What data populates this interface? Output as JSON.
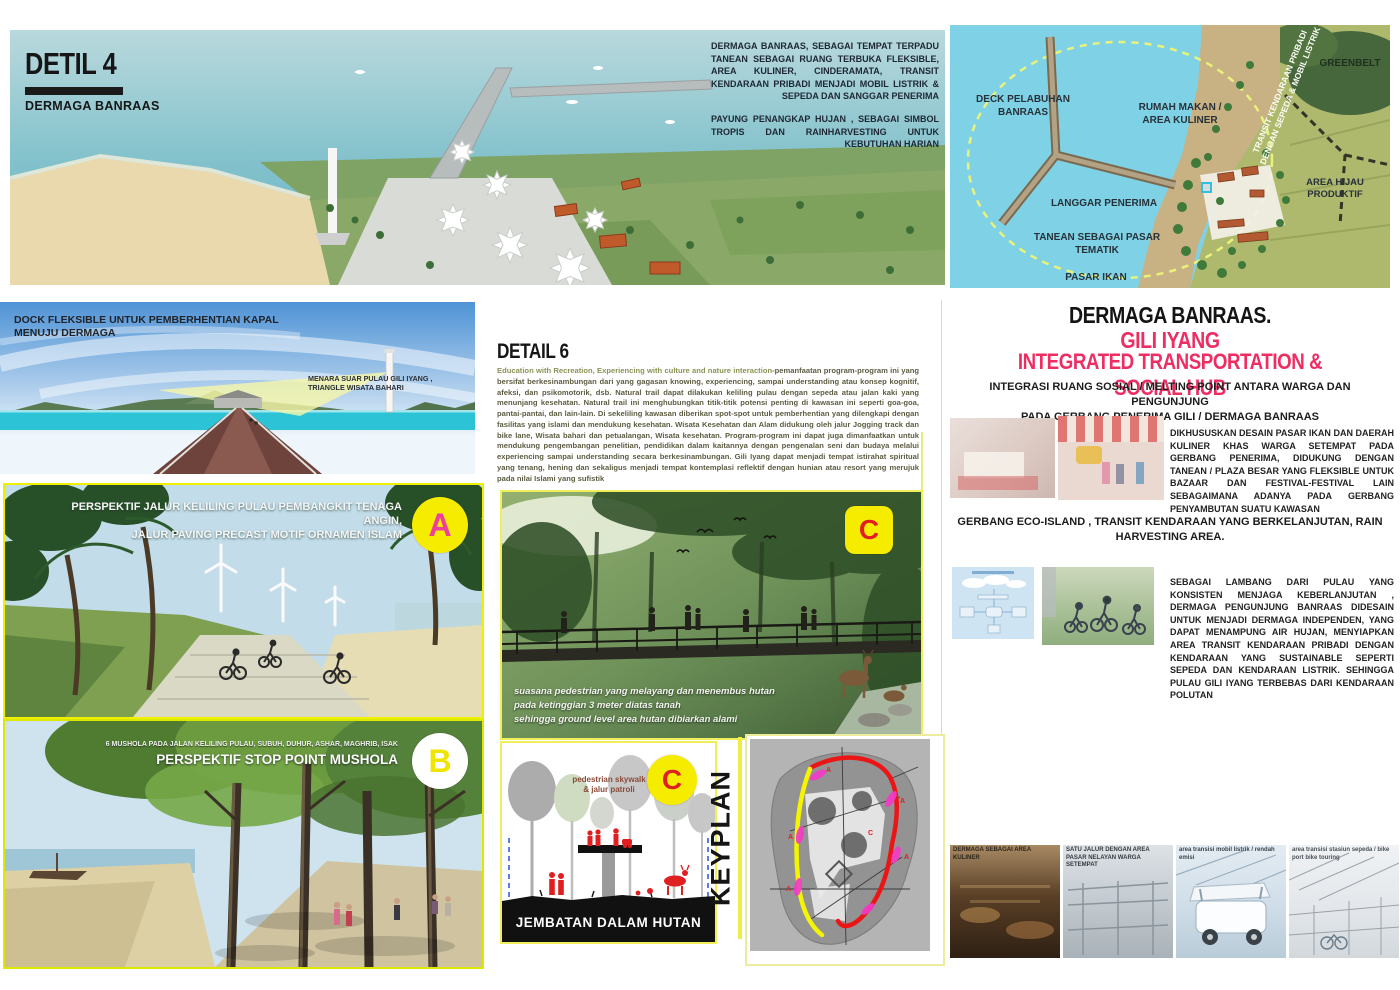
{
  "detail4": {
    "title": "DETIL 4",
    "subtitle": "DERMAGA BANRAAS",
    "para1": "DERMAGA BANRAAS, SEBAGAI TEMPAT TERPADU TANEAN SEBAGAI RUANG TERBUKA FLEKSIBLE, AREA KULINER, CINDERAMATA, TRANSIT KENDARAAN PRIBADI MENJADI MOBIL LISTRIK & SEPEDA DAN SANGGAR PENERIMA",
    "para2": "PAYUNG PENANGKAP HUJAN , SEBAGAI SIMBOL TROPIS DAN RAINHARVESTING UNTUK KEBUTUHAN HARIAN"
  },
  "siteplan": {
    "deck": "DECK PELABUHAN\nBANRAAS",
    "rumah": "RUMAH MAKAN /\nAREA KULINER",
    "greenbelt": "GREENBELT",
    "langgar": "LANGGAR PENERIMA",
    "tanean": "TANEAN SEBAGAI PASAR\nTEMATIK",
    "pasar": "PASAR IKAN",
    "hijau": "AREA HIJAU PRODUKTIF",
    "transit": "TRANSIT KENDARAAN PRIBADI\nDENGAN SEPEDA & MOBIL LISTRIK"
  },
  "dock": {
    "caption": "DOCK FLEKSIBLE UNTUK PEMBERHENTIAN KAPAL\nMENUJU DERMAGA",
    "tower_label": "MENARA SUAR PULAU GILI IYANG ,\nTRIANGLE WISATA BAHARI"
  },
  "detail6": {
    "title": "DETAIL 6",
    "lead": "Education with Recreation, Experiencing with culture and nature interaction",
    "body": "-pemanfaatan program-program ini yang bersifat berkesinambungan dari yang gagasan knowing, experiencing, sampai understanding atau konsep kognitif, afeksi, dan psikomotorik, dsb. Natural trail dapat dilakukan keliling pulau dengan sepeda atau jalan kaki yang menunjang kesehatan. Natural trail ini menghubungkan titik-titik potensi penting di kawasan ini seperti goa-goa, pantai-pantai, dan lain-lain. Di sekeliling kawasan diberikan spot-spot untuk pemberhentian yang dilengkapi dengan fasilitas yang islami dan mendukung kesehatan. Wisata Kesehatan dan Alam didukung oleh jalur Jogging track dan bike lane, Wisata bahari dan petualangan, Wisata kesehatan. Program-program ini dapat juga dimanfaatkan untuk mendukung pengembangan penelitian, pendidikan dalam kaitannya dengan pengenalan seni dan budaya melalui experiencing sampai understanding secara berkesinambungan. Gili Iyang dapat menjadi tempat istirahat spiritual yang tenang, hening dan sekaligus menjadi tempat kontemplasi reflektif dengan hunian atau resort yang merujuk pada nilai Islami yang sufistik"
  },
  "panel_a": {
    "marker": "A",
    "caption": "PERSPEKTIF JALUR KELILING PULAU PEMBANGKIT TENAGA ANGIN,\nJALUR PAVING PRECAST MOTIF ORNAMEN ISLAM"
  },
  "panel_b": {
    "marker": "B",
    "caption_small": "6 MUSHOLA PADA JALAN KELILING PULAU, SUBUH, DUHUR, ASHAR, MAGHRIB, ISAK",
    "caption": "PERSPEKTIF STOP POINT MUSHOLA"
  },
  "panel_c_photo": {
    "marker": "C",
    "caption": "suasana pedestrian yang melayang dan menembus hutan\npada ketinggian 3 meter diatas tanah\nsehingga ground level area hutan dibiarkan alami"
  },
  "panel_c_diagram": {
    "marker": "C",
    "label": "pedestrian skywalk\n& jalur patroli",
    "title": "JEMBATAN DALAM HUTAN"
  },
  "keyplan": {
    "label": "KEYPLAN",
    "point_labels": [
      "A",
      "A",
      "A",
      "A",
      "A",
      "C"
    ]
  },
  "right": {
    "title1": "DERMAGA BANRAAS.",
    "title2": "GILI IYANG",
    "title3": "INTEGRATED TRANSPORTATION & SOCIAL HUB",
    "sub1": "INTEGRASI RUANG SOSIAL / MELTING POINT ANTARA WARGA DAN PENGUNJUNG\nPADA GERBANG PENERIMA GILI / DERMAGA BANRAAS",
    "block1": "DIKHUSUSKAN DESAIN PASAR IKAN DAN DAERAH KULINER KHAS WARGA SETEMPAT PADA GERBANG PENERIMA, DIDUKUNG DENGAN TANEAN / PLAZA BESAR YANG FLEKSIBLE UNTUK BAZAAR DAN FESTIVAL-FESTIVAL LAIN SEBAGAIMANA ADANYA PADA GERBANG PENYAMBUTAN SUATU KAWASAN",
    "sub2": "GERBANG ECO-ISLAND , TRANSIT KENDARAAN YANG BERKELANJUTAN, RAIN\nHARVESTING AREA.",
    "block2": "SEBAGAI LAMBANG DARI PULAU YANG KONSISTEN MENJAGA KEBERLANJUTAN , DERMAGA PENGUNJUNG BANRAAS DIDESAIN UNTUK MENJADI DERMAGA INDEPENDEN, YANG DAPAT MENAMPUNG AIR HUJAN, MENYIAPKAN AREA TRANSIT KENDARAAN PRIBADI DENGAN KENDARAAN YANG SUSTAINABLE SEPERTI SEPEDA DAN KENDARAAN LISTRIK. SEHINGGA PULAU GILI IYANG TERBEBAS DARI KENDARAAN POLUTAN"
  },
  "bottom_strip": [
    {
      "caption": "DERMAGA SEBAGAI AREA KULINER"
    },
    {
      "caption": "SATU JALUR DENGAN AREA PASAR NELAYAN WARGA SETEMPAT"
    },
    {
      "caption": "area transisi mobil listrik / rendah emisi"
    },
    {
      "caption": "area transisi stasiun sepeda / bike port bike touring"
    }
  ],
  "colors": {
    "accent_pink": "#ee2d63",
    "marker_yellow": "#f6ec00",
    "marker_letter_pink": "#ee3f9e",
    "marker_letter_red": "#e02020",
    "keyplan_route_red": "#ec1515",
    "keyplan_route_yellow": "#f5f500",
    "keyplan_magenta": "#f23cc8",
    "siteplan_water": "#7fd2e6"
  }
}
